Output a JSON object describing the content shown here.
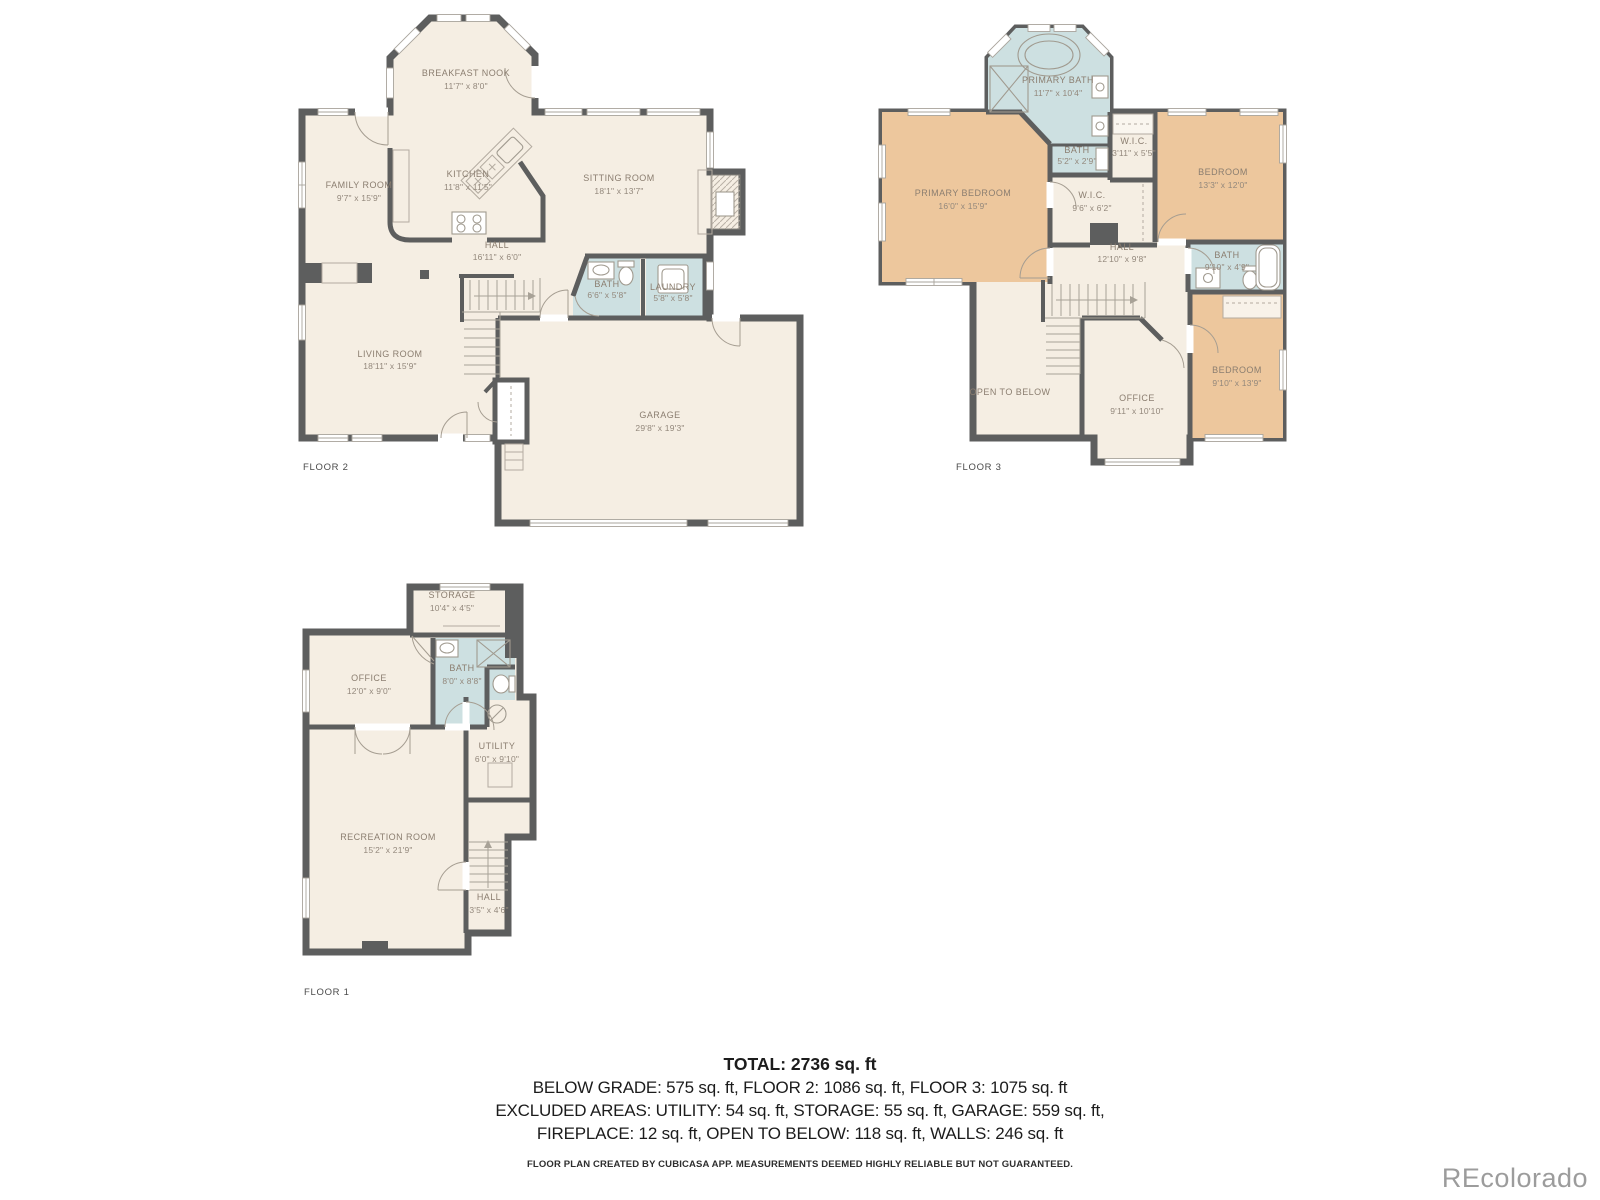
{
  "colors": {
    "wall": "#5d5e5e",
    "floor": "#f5eee3",
    "bath": "#cde0e1",
    "bedroom": "#edc79d",
    "room_label": "#8b7e70",
    "floor_label": "#4a4a4a",
    "summary_text": "#1c1c1c",
    "watermark": "#9c9c9c"
  },
  "floor2": {
    "label": "FLOOR 2",
    "rooms": {
      "breakfast_nook": {
        "name": "BREAKFAST NOOK",
        "dims": "11'7\" x 8'0\""
      },
      "family_room": {
        "name": "FAMILY ROOM",
        "dims": "9'7\" x 15'9\""
      },
      "kitchen": {
        "name": "KITCHEN",
        "dims": "11'8\" x 11'5\""
      },
      "sitting_room": {
        "name": "SITTING ROOM",
        "dims": "18'1\" x 13'7\""
      },
      "hall": {
        "name": "HALL",
        "dims": "16'11\" x 6'0\""
      },
      "bath": {
        "name": "BATH",
        "dims": "6'6\" x 5'8\""
      },
      "laundry": {
        "name": "LAUNDRY",
        "dims": "5'8\" x 5'8\""
      },
      "living_room": {
        "name": "LIVING ROOM",
        "dims": "18'11\" x 15'9\""
      },
      "garage": {
        "name": "GARAGE",
        "dims": "29'8\" x 19'3\""
      }
    }
  },
  "floor3": {
    "label": "FLOOR 3",
    "rooms": {
      "primary_bath": {
        "name": "PRIMARY BATH",
        "dims": "11'7\" x 10'4\""
      },
      "primary_bedroom": {
        "name": "PRIMARY BEDROOM",
        "dims": "16'0\" x 15'9\""
      },
      "bath": {
        "name": "BATH",
        "dims": "5'2\" x 2'9\""
      },
      "wic_small": {
        "name": "W.I.C.",
        "dims": "3'11\" x 5'5\""
      },
      "bedroom_ne": {
        "name": "BEDROOM",
        "dims": "13'3\" x 12'0\""
      },
      "wic": {
        "name": "W.I.C.",
        "dims": "9'6\" x 6'2\""
      },
      "hall": {
        "name": "HALL",
        "dims": "12'10\" x 9'8\""
      },
      "bath_hall": {
        "name": "BATH",
        "dims": "9'10\" x 4'9\""
      },
      "open_to_below": {
        "name": "OPEN TO BELOW"
      },
      "office": {
        "name": "OFFICE",
        "dims": "9'11\" x 10'10\""
      },
      "bedroom_se": {
        "name": "BEDROOM",
        "dims": "9'10\" x 13'9\""
      }
    }
  },
  "floor1": {
    "label": "FLOOR 1",
    "rooms": {
      "storage": {
        "name": "STORAGE",
        "dims": "10'4\" x 4'5\""
      },
      "office": {
        "name": "OFFICE",
        "dims": "12'0\" x 9'0\""
      },
      "bath": {
        "name": "BATH",
        "dims": "8'0\" x 8'8\""
      },
      "utility": {
        "name": "UTILITY",
        "dims": "6'0\" x 9'10\""
      },
      "recreation_room": {
        "name": "RECREATION ROOM",
        "dims": "15'2\" x 21'9\""
      },
      "hall": {
        "name": "HALL",
        "dims": "3'5\" x 4'6\""
      }
    }
  },
  "summary": {
    "total": "TOTAL: 2736 sq. ft",
    "areas_line": "BELOW GRADE: 575 sq. ft, FLOOR 2: 1086 sq. ft, FLOOR 3: 1075 sq. ft",
    "excluded_line1": "EXCLUDED AREAS: UTILITY: 54 sq. ft, STORAGE: 55 sq. ft, GARAGE: 559 sq. ft,",
    "excluded_line2": "FIREPLACE: 12 sq. ft, OPEN TO BELOW: 118 sq. ft, WALLS: 246 sq. ft",
    "disclaimer": "FLOOR PLAN CREATED BY CUBICASA APP. MEASUREMENTS DEEMED HIGHLY RELIABLE BUT NOT GUARANTEED.",
    "watermark": "REcolorado"
  }
}
